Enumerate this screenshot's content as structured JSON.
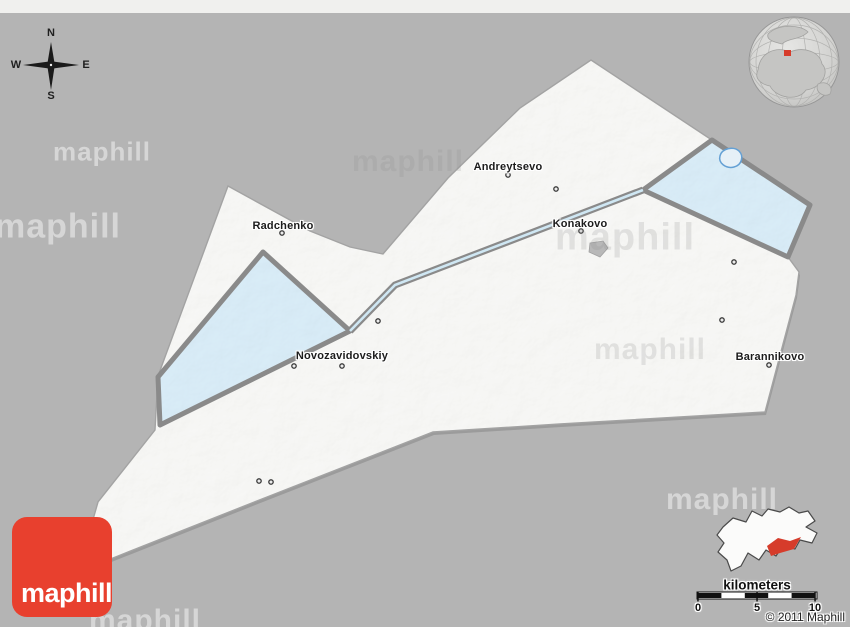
{
  "canvas": {
    "width": 850,
    "height": 627
  },
  "compass": {
    "north": "N",
    "south": "S",
    "east": "E",
    "west": "W"
  },
  "watermark": {
    "text": "maphill"
  },
  "logo": {
    "text": "maphill",
    "background": "#e8402e"
  },
  "map": {
    "places": [
      {
        "name": "Andreytsevo"
      },
      {
        "name": "Radchenko"
      },
      {
        "name": "Konakovo"
      },
      {
        "name": "Novozavidovskiy"
      },
      {
        "name": "Barannikovo"
      }
    ],
    "colors": {
      "background": "#b4b4b4",
      "land": "#f4f4f2",
      "region_highlight": "#d6e9f4",
      "border": "#8a8a8a",
      "canal": "#cfe7f3",
      "lake_gray": "#b8b8b8",
      "lake_outline": "#64a0d4",
      "marker": "#3a3a3a",
      "locator_red": "#d63c2b"
    }
  },
  "scale_bar": {
    "label": "kilometers",
    "ticks": [
      "0",
      "5",
      "10"
    ]
  },
  "copyright": "© 2011 Maphill"
}
